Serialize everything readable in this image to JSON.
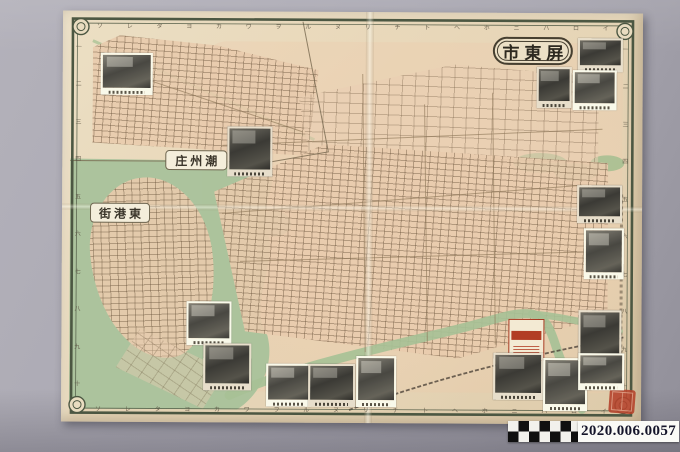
{
  "map": {
    "title": "屏東市",
    "title_display": "市東屏",
    "inset_labels": [
      {
        "name": "潮州庄",
        "display": "庄州潮"
      },
      {
        "name": "東港街",
        "display": "街港東"
      }
    ],
    "border_letters_top": [
      "ソ",
      "レ",
      "タ",
      "ヨ",
      "カ",
      "ワ",
      "ヲ",
      "ル",
      "ヌ",
      "リ",
      "チ",
      "ト",
      "ヘ",
      "ホ",
      "ニ",
      "ハ",
      "ロ",
      "イ"
    ],
    "border_letters_bottom": [
      "ソ",
      "レ",
      "タ",
      "ヨ",
      "カ",
      "ワ",
      "ヲ",
      "ル",
      "ヌ",
      "リ",
      "チ",
      "ト",
      "ヘ",
      "ホ",
      "ニ",
      "ハ",
      "ロ",
      "イ"
    ],
    "border_numbers_left": [
      "一",
      "二",
      "三",
      "四",
      "五",
      "六",
      "七",
      "八",
      "九",
      "十"
    ],
    "border_numbers_right": [
      "一",
      "二",
      "三",
      "四",
      "五",
      "六",
      "七",
      "八",
      "九",
      "十"
    ]
  },
  "catalog": {
    "number": "2020.006.0057"
  },
  "colors": {
    "backdrop_gray": "#aaa8b2",
    "paper_cream": "#e7d7b9",
    "city_block_tint": "#e9cbad",
    "water_green": "#a9c29b",
    "frame_olive": "#4c5742",
    "seal_red": "#b5442c",
    "ad_red": "#b23d24",
    "catalog_text_navy": "#15152a"
  }
}
